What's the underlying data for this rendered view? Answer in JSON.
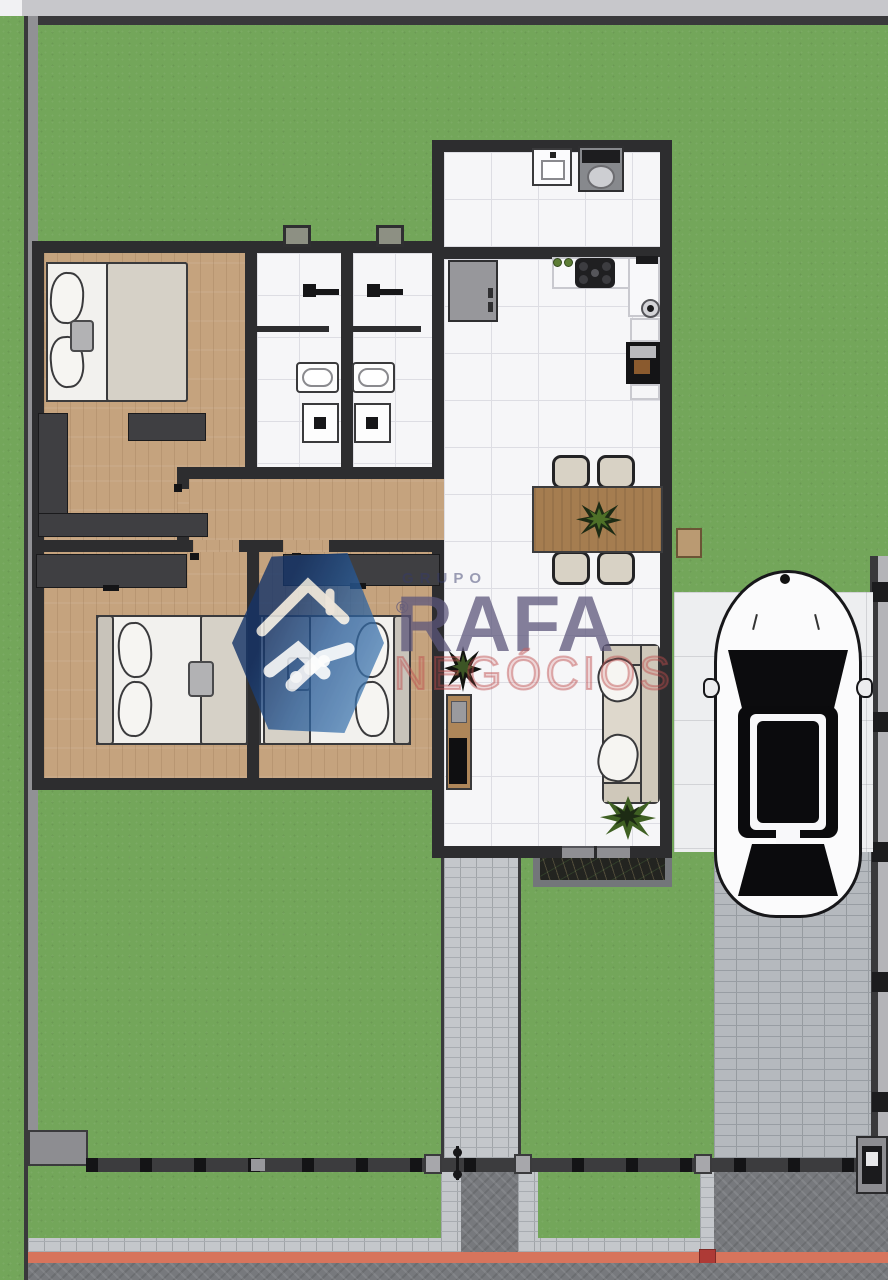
{
  "watermark": {
    "group": "GRUPO",
    "brand": "RAFA",
    "registered": "®",
    "subtitle": "NEGÓCIOS"
  },
  "palette": {
    "grass": "#73a65a",
    "wall": "#2d2d2f",
    "boundary_gray": "#919195",
    "wood": "#c5a37e",
    "tile": "#f6f6f8",
    "tile_line": "#dddde3",
    "paver_light": "#c4c7cb",
    "brick_drive": "#b5b9be",
    "herringbone": "#77797d",
    "curb_red": "#d7745c",
    "curb_red_dark": "#ae3a36",
    "soil": "#232420",
    "table_wood": "#a57d50",
    "furniture_dark": "#3f3f42",
    "fabric": "#d6d1c7",
    "sofa": "#ded8cc",
    "logo_blue_dark": "#1a3a6e",
    "logo_blue": "#2e6aa8",
    "brand_purple": "#5c567a",
    "brand_red": "#be4b4b",
    "car_white": "#fbfbfc",
    "pad_white": "#edeef0"
  }
}
